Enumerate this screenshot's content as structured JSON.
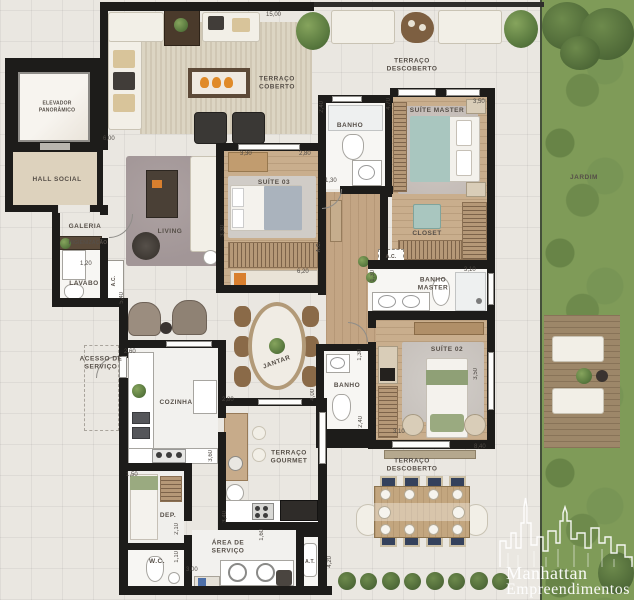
{
  "branding": {
    "line1": "Manhattan",
    "line2": "Empreendimentos"
  },
  "rooms": {
    "elevador": "ELEVADOR\nPANORÂMICO",
    "hall_social": "HALL SOCIAL",
    "galeria": "GALERIA",
    "higienizacao": "HIGIENIZAÇÃO",
    "lavabo": "LAVABO",
    "ac": "A.C.",
    "terraco_coberto": "TERRAÇO\nCOBERTO",
    "terraco_descoberto_top": "TERRAÇO\nDESCOBERTO",
    "living": "LIVING",
    "suite03": "SUÍTE 03",
    "banho_suite03": "BANHO",
    "suite_master": "SUÍTE MASTER",
    "closet": "CLOSET",
    "banho_master": "BANHO\nMASTER",
    "jardim": "JARDIM",
    "suite02": "SUÍTE 02",
    "banho_suite02": "BANHO",
    "jantar": "JANTAR",
    "acesso_servico": "ACESSO DE\nSERVIÇO",
    "cozinha": "COZINHA",
    "terraco_gourmet": "TERRAÇO\nGOURMET",
    "dep": "DEP.",
    "wc": "W.C.",
    "area_servico": "ÁREA DE\nSERVIÇO",
    "at": "A.T.",
    "terraco_descoberto_bottom": "TERRAÇO\nDESCOBERTO"
  },
  "dims": [
    "15,00",
    "6,00",
    "3,30",
    "2,80",
    "2,40",
    "4,70",
    "3,50",
    "1,30",
    "3,30",
    "6,20",
    "1,20",
    "5,40",
    "2,60",
    "1,30",
    "3,10",
    "2,80",
    "4,00",
    "3,60",
    "1,30",
    "3,50",
    "2,40",
    "3,10",
    "8,40",
    "1,50",
    "2,10",
    "1,10",
    "3,00",
    "3,40",
    "1,60",
    "4,20"
  ],
  "colors": {
    "wall": "#1d1c1a",
    "wood": "#c9ae8d",
    "garden": "#7f9b58",
    "accent_teal": "#a9c6bf",
    "deck": "#9d8769"
  }
}
